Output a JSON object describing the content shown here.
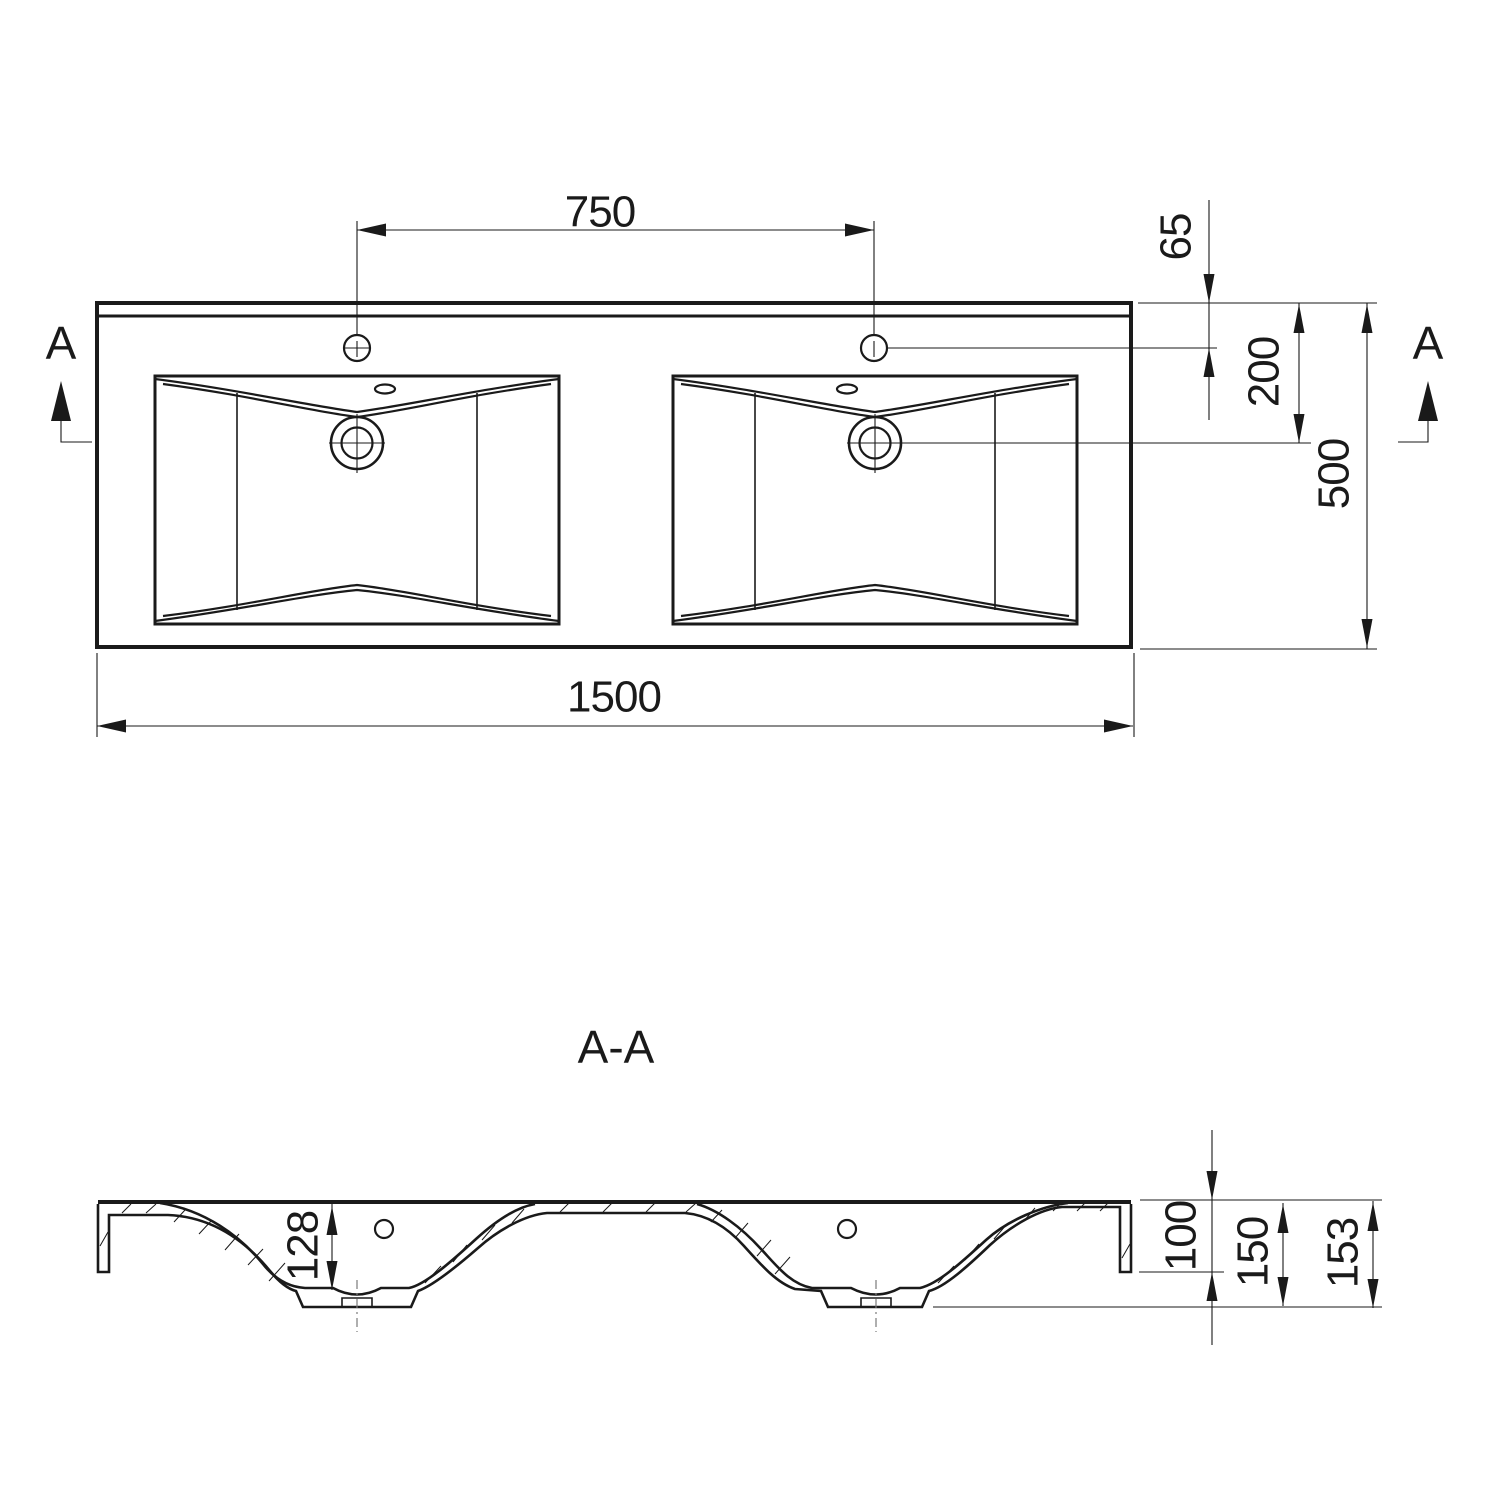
{
  "drawing": {
    "type": "technical-drawing",
    "subject": "double-basin-vanity-washbasin",
    "colors": {
      "line": "#1a1a1a",
      "background": "#ffffff",
      "centerline": "#7a7a7a"
    },
    "section_title": "A-A",
    "section_marker": "A",
    "top_view": {
      "overall_width_mm": "1500",
      "overall_depth_mm": "500",
      "faucet_hole_spacing_mm": "750",
      "faucet_hole_from_back_mm": "65",
      "drain_from_back_mm": "200"
    },
    "section_view": {
      "basin_depth_mm": "128",
      "front_edge_height_mm": "100",
      "height_to_drain_boss_mm": "150",
      "overall_height_mm": "153"
    }
  }
}
